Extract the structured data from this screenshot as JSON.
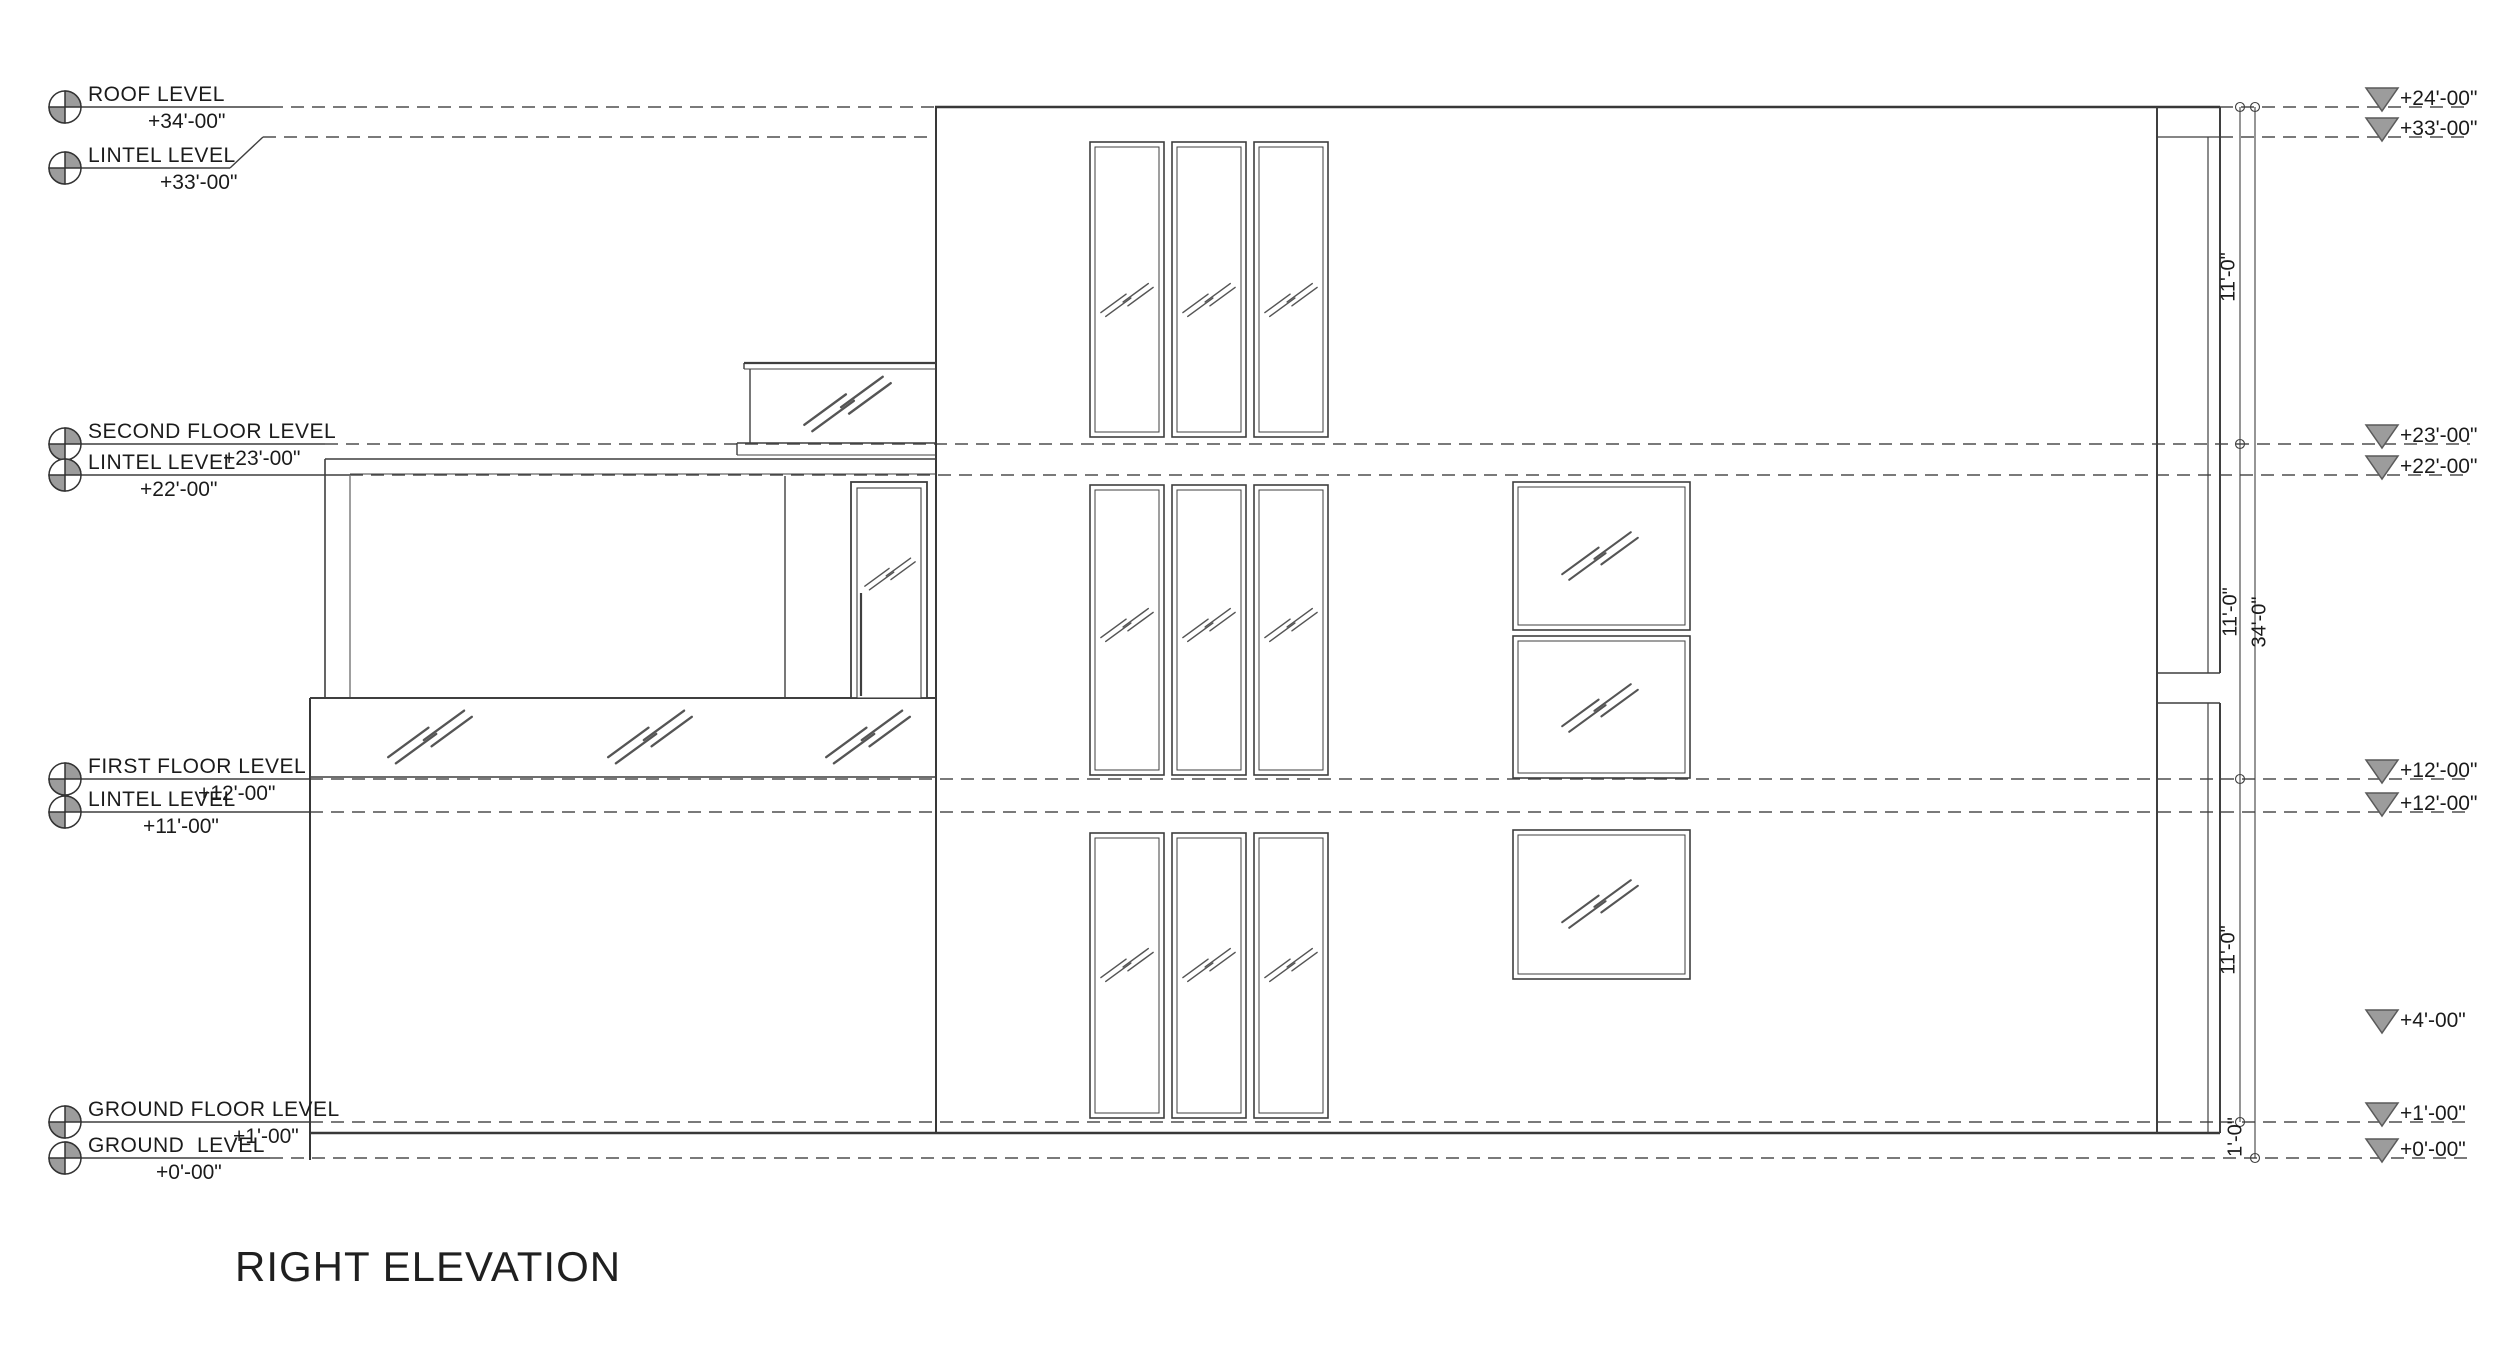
{
  "title": "RIGHT ELEVATION",
  "left_levels": [
    {
      "name": "ROOF LEVEL",
      "value": "+34'-00\""
    },
    {
      "name": "LINTEL LEVEL",
      "value": "+33'-00\""
    },
    {
      "name": "SECOND FLOOR LEVEL",
      "value": "+23'-00\""
    },
    {
      "name": "LINTEL LEVEL",
      "value": "+22'-00\""
    },
    {
      "name": "FIRST FLOOR LEVEL",
      "value": "+12'-00\""
    },
    {
      "name": "LINTEL LEVEL",
      "value": "+11'-00\""
    },
    {
      "name": "GROUND FLOOR LEVEL",
      "value": "+1'-00\""
    },
    {
      "name": "GROUND  LEVEL",
      "value": "+0'-00\""
    }
  ],
  "right_markers": [
    {
      "value": "+24'-00\""
    },
    {
      "value": "+33'-00\""
    },
    {
      "value": "+23'-00\""
    },
    {
      "value": "+22'-00\""
    },
    {
      "value": "+12'-00\""
    },
    {
      "value": "+12'-00\""
    },
    {
      "value": "+4'-00\""
    },
    {
      "value": "+1'-00\""
    },
    {
      "value": "+0'-00\""
    }
  ],
  "dimensions": {
    "upper": "11'-0\"",
    "middle_inner": "11'-0\"",
    "overall": "34'-0\"",
    "lower": "11'-0\"",
    "base": "1'-0\""
  },
  "colors": {
    "solid_line": "#3f3f3f",
    "dashed_line": "#4f4f4f",
    "marker_gray": "#9c9c9c"
  }
}
